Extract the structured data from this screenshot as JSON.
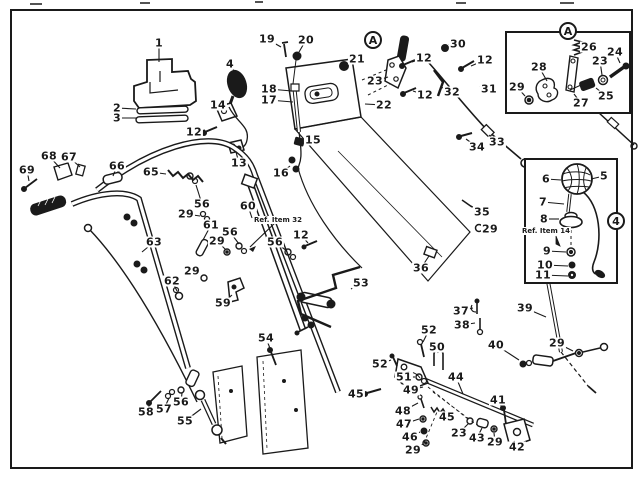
{
  "figure": {
    "colors": {
      "paper": "#ffffff",
      "ink": "#1a1a1a"
    },
    "insets": [
      {
        "marker": "A",
        "note": ""
      },
      {
        "marker": "4",
        "note": "Ref. Item 14"
      }
    ],
    "reference_notes": [
      "Ref. Item 32",
      "Ref. Item 14"
    ],
    "callouts": [
      {
        "t": "1",
        "x": 159,
        "y": 43,
        "lx": 159,
        "ly": 62
      },
      {
        "t": "2",
        "x": 117,
        "y": 108,
        "lx": 136,
        "ly": 109
      },
      {
        "t": "3",
        "x": 117,
        "y": 118,
        "lx": 137,
        "ly": 118
      },
      {
        "t": "4",
        "x": 230,
        "y": 64,
        "lx": 236,
        "ly": 74
      },
      {
        "t": "14",
        "x": 218,
        "y": 105,
        "lx": 223,
        "ly": 109
      },
      {
        "t": "12",
        "x": 194,
        "y": 132,
        "lx": 205,
        "ly": 130
      },
      {
        "t": "13",
        "x": 239,
        "y": 163,
        "lx": 236,
        "ly": 152
      },
      {
        "t": "19",
        "x": 267,
        "y": 39,
        "lx": 281,
        "ly": 47
      },
      {
        "t": "20",
        "x": 306,
        "y": 40,
        "lx": 299,
        "ly": 52
      },
      {
        "t": "18",
        "x": 269,
        "y": 89,
        "lx": 292,
        "ly": 91
      },
      {
        "t": "17",
        "x": 269,
        "y": 100,
        "lx": 293,
        "ly": 102
      },
      {
        "t": "15",
        "x": 313,
        "y": 140,
        "lx": 304,
        "ly": 141
      },
      {
        "t": "16",
        "x": 281,
        "y": 173,
        "lx": 290,
        "ly": 166
      },
      {
        "t": "65",
        "x": 151,
        "y": 172,
        "lx": 166,
        "ly": 174
      },
      {
        "t": "66",
        "x": 117,
        "y": 166,
        "lx": 113,
        "ly": 176
      },
      {
        "t": "67",
        "x": 69,
        "y": 157,
        "lx": 80,
        "ly": 167
      },
      {
        "t": "68",
        "x": 49,
        "y": 156,
        "lx": 60,
        "ly": 168
      },
      {
        "t": "69",
        "x": 27,
        "y": 170,
        "lx": 29,
        "ly": 181
      },
      {
        "t": "56",
        "x": 202,
        "y": 204,
        "lx": 196,
        "ly": 185
      },
      {
        "t": "29",
        "x": 186,
        "y": 214,
        "lx": 200,
        "ly": 216
      },
      {
        "t": "60",
        "x": 248,
        "y": 206,
        "lx": 252,
        "ly": 218
      },
      {
        "t": "61",
        "x": 211,
        "y": 225,
        "lx": 203,
        "ly": 240
      },
      {
        "t": "56",
        "x": 230,
        "y": 232,
        "lx": 239,
        "ly": 244
      },
      {
        "t": "29",
        "x": 217,
        "y": 241,
        "lx": 226,
        "ly": 250
      },
      {
        "t": "56",
        "x": 275,
        "y": 242,
        "lx": 287,
        "ly": 251
      },
      {
        "t": "12",
        "x": 301,
        "y": 235,
        "lx": 308,
        "ly": 243
      },
      {
        "t": "Ref. Item 32",
        "x": 278,
        "y": 220,
        "kind": "ref",
        "lx": 250,
        "ly": 247
      },
      {
        "t": "29",
        "x": 192,
        "y": 271,
        "lx": 202,
        "ly": 277
      },
      {
        "t": "62",
        "x": 172,
        "y": 281,
        "lx": 177,
        "ly": 291
      },
      {
        "t": "63",
        "x": 154,
        "y": 242,
        "lx": 142,
        "ly": 252
      },
      {
        "t": "59",
        "x": 223,
        "y": 303,
        "lx": 232,
        "ly": 295
      },
      {
        "t": "54",
        "x": 266,
        "y": 338,
        "lx": 271,
        "ly": 351
      },
      {
        "t": "55",
        "x": 185,
        "y": 421,
        "lx": 201,
        "ly": 409
      },
      {
        "t": "56",
        "x": 181,
        "y": 402,
        "lx": 182,
        "ly": 393
      },
      {
        "t": "57",
        "x": 164,
        "y": 409,
        "lx": 169,
        "ly": 398
      },
      {
        "t": "58",
        "x": 146,
        "y": 412,
        "lx": 151,
        "ly": 402
      },
      {
        "t": "A",
        "x": 373,
        "y": 40,
        "kind": "circle"
      },
      {
        "t": "21",
        "x": 357,
        "y": 59,
        "lx": 348,
        "ly": 64
      },
      {
        "t": "23",
        "x": 375,
        "y": 81,
        "lx": 388,
        "ly": 77
      },
      {
        "t": "22",
        "x": 384,
        "y": 105,
        "lx": 365,
        "ly": 104
      },
      {
        "t": "12",
        "x": 424,
        "y": 58,
        "lx": 412,
        "ly": 62
      },
      {
        "t": "12",
        "x": 425,
        "y": 95,
        "lx": 413,
        "ly": 91
      },
      {
        "t": "30",
        "x": 458,
        "y": 44,
        "lx": 449,
        "ly": 47
      },
      {
        "t": "12",
        "x": 485,
        "y": 60,
        "lx": 471,
        "ly": 66
      },
      {
        "t": "32",
        "x": 452,
        "y": 92,
        "lx": 441,
        "ly": 87
      },
      {
        "t": "31",
        "x": 489,
        "y": 89,
        "lx": 480,
        "ly": 86
      },
      {
        "t": "34",
        "x": 477,
        "y": 147,
        "lx": 466,
        "ly": 139
      },
      {
        "t": "33",
        "x": 497,
        "y": 142,
        "lx": 489,
        "ly": 135
      },
      {
        "t": "35",
        "x": 482,
        "y": 212,
        "lx": 471,
        "ly": 206
      },
      {
        "t": "29",
        "x": 490,
        "y": 229,
        "lx": 482,
        "ly": 229
      },
      {
        "t": "36",
        "x": 421,
        "y": 268,
        "lx": 429,
        "ly": 256
      },
      {
        "t": "53",
        "x": 361,
        "y": 283,
        "lx": 351,
        "ly": 289
      },
      {
        "t": "37",
        "x": 461,
        "y": 311,
        "lx": 473,
        "ly": 308
      },
      {
        "t": "38",
        "x": 462,
        "y": 325,
        "lx": 475,
        "ly": 323
      },
      {
        "t": "39",
        "x": 525,
        "y": 308,
        "lx": 546,
        "ly": 317
      },
      {
        "t": "40",
        "x": 496,
        "y": 345,
        "lx": 519,
        "ly": 360
      },
      {
        "t": "29",
        "x": 557,
        "y": 343,
        "lx": 573,
        "ly": 351
      },
      {
        "t": "52",
        "x": 429,
        "y": 330,
        "lx": 423,
        "ly": 342
      },
      {
        "t": "50",
        "x": 437,
        "y": 347,
        "lx": 438,
        "ly": 353
      },
      {
        "t": "52",
        "x": 380,
        "y": 364,
        "lx": 391,
        "ly": 360
      },
      {
        "t": "51",
        "x": 404,
        "y": 377,
        "lx": 415,
        "ly": 377
      },
      {
        "t": "49",
        "x": 411,
        "y": 390,
        "lx": 423,
        "ly": 387
      },
      {
        "t": "48",
        "x": 403,
        "y": 411,
        "lx": 418,
        "ly": 403
      },
      {
        "t": "47",
        "x": 404,
        "y": 424,
        "lx": 419,
        "ly": 419
      },
      {
        "t": "46",
        "x": 410,
        "y": 437,
        "lx": 420,
        "ly": 432
      },
      {
        "t": "29",
        "x": 413,
        "y": 450,
        "lx": 423,
        "ly": 444
      },
      {
        "t": "45",
        "x": 356,
        "y": 394,
        "lx": 365,
        "ly": 392
      },
      {
        "t": "44",
        "x": 456,
        "y": 377,
        "lx": 463,
        "ly": 394
      },
      {
        "t": "45",
        "x": 447,
        "y": 417,
        "lx": 440,
        "ly": 411
      },
      {
        "t": "23",
        "x": 459,
        "y": 433,
        "lx": 468,
        "ly": 424
      },
      {
        "t": "43",
        "x": 477,
        "y": 438,
        "lx": 482,
        "ly": 428
      },
      {
        "t": "29",
        "x": 495,
        "y": 442,
        "lx": 494,
        "ly": 433
      },
      {
        "t": "41",
        "x": 498,
        "y": 400,
        "lx": 503,
        "ly": 410
      },
      {
        "t": "42",
        "x": 517,
        "y": 447,
        "lx": 514,
        "ly": 441
      },
      {
        "t": "A",
        "x": 568,
        "y": 31,
        "kind": "circle"
      },
      {
        "t": "26",
        "x": 589,
        "y": 47,
        "lx": 581,
        "ly": 49
      },
      {
        "t": "24",
        "x": 615,
        "y": 52,
        "lx": 620,
        "ly": 63
      },
      {
        "t": "23",
        "x": 600,
        "y": 61,
        "lx": 602,
        "ly": 75
      },
      {
        "t": "28",
        "x": 539,
        "y": 67,
        "lx": 547,
        "ly": 81
      },
      {
        "t": "29",
        "x": 517,
        "y": 87,
        "lx": 525,
        "ly": 96
      },
      {
        "t": "27",
        "x": 581,
        "y": 103,
        "lx": 574,
        "ly": 94
      },
      {
        "t": "25",
        "x": 606,
        "y": 96,
        "lx": 596,
        "ly": 88
      },
      {
        "t": "4",
        "x": 616,
        "y": 221,
        "kind": "circle"
      },
      {
        "t": "6",
        "x": 546,
        "y": 179,
        "lx": 561,
        "ly": 180
      },
      {
        "t": "5",
        "x": 604,
        "y": 176,
        "lx": 591,
        "ly": 179
      },
      {
        "t": "7",
        "x": 543,
        "y": 202,
        "lx": 564,
        "ly": 204
      },
      {
        "t": "8",
        "x": 544,
        "y": 219,
        "lx": 559,
        "ly": 219
      },
      {
        "t": "Ref. Item 14",
        "x": 546,
        "y": 231,
        "kind": "ref"
      },
      {
        "t": "9",
        "x": 547,
        "y": 251,
        "lx": 566,
        "ly": 252
      },
      {
        "t": "10",
        "x": 545,
        "y": 265,
        "lx": 568,
        "ly": 266
      },
      {
        "t": "11",
        "x": 543,
        "y": 275,
        "lx": 568,
        "ly": 276
      }
    ]
  }
}
